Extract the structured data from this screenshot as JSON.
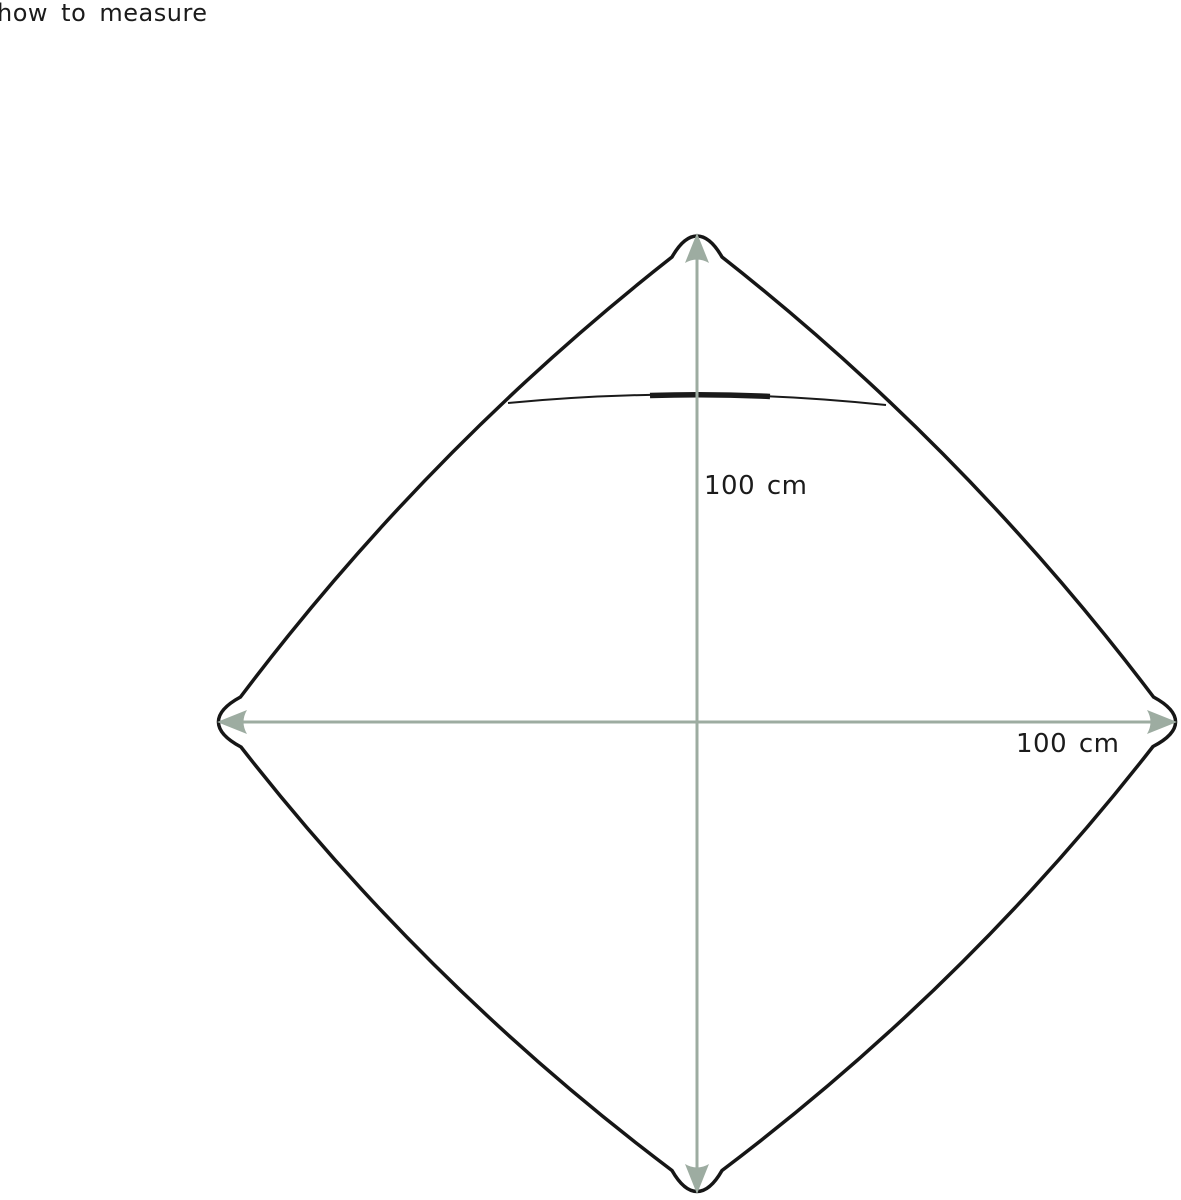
{
  "title": "how to measure",
  "colors": {
    "outline": "#161616",
    "seam": "#1a1a1a",
    "arrow": "#9daca1",
    "label": "#1b1b1b",
    "background": "#ffffff"
  },
  "diagram": {
    "subject": "hooded blanket laid out as rounded diamond",
    "vertical": {
      "label": "100 cm"
    },
    "horizontal": {
      "label": "100 cm"
    }
  }
}
